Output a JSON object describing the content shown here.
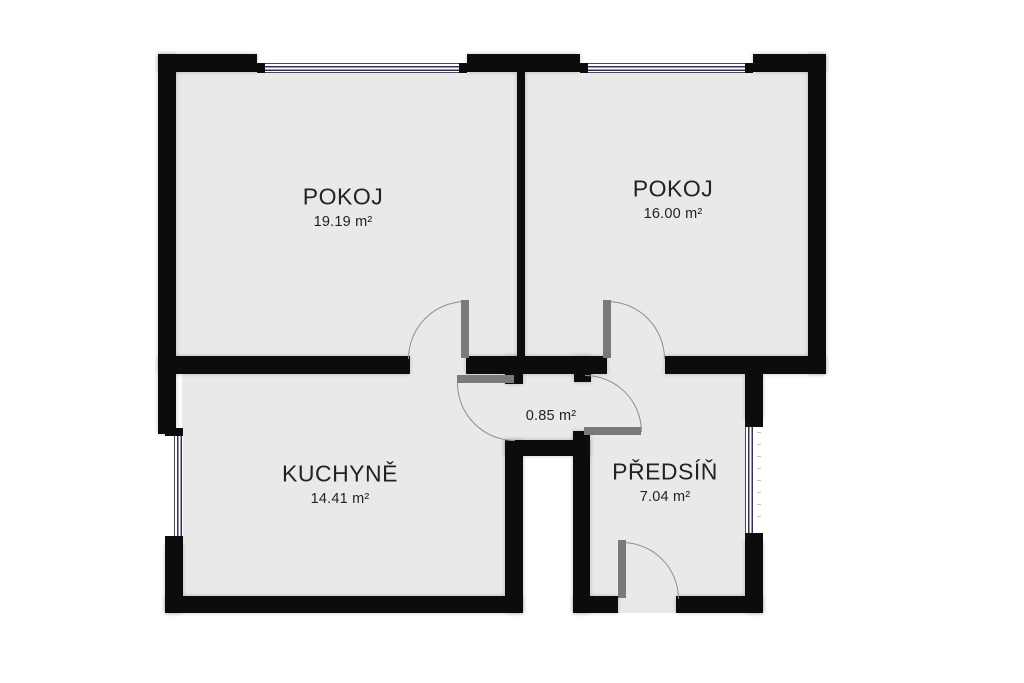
{
  "rooms": [
    {
      "id": "pokoj-left",
      "name": "POKOJ",
      "area": "19.19 m²"
    },
    {
      "id": "pokoj-right",
      "name": "POKOJ",
      "area": "16.00 m²"
    },
    {
      "id": "kuchyne",
      "name": "KUCHYNĚ",
      "area": "14.41 m²"
    },
    {
      "id": "predsin",
      "name": "PŘEDSÍŇ",
      "area": "7.04 m²"
    },
    {
      "id": "vestibule",
      "name": "",
      "area": "0.85 m²"
    }
  ],
  "colors": {
    "wall": "#0c0c0c",
    "floor": "#e9e9e9",
    "window_line": "#31315c",
    "door_leaf": "#7a7a7a",
    "door_arc": "#8f8f8f",
    "text": "#222224",
    "background": "#ffffff"
  }
}
